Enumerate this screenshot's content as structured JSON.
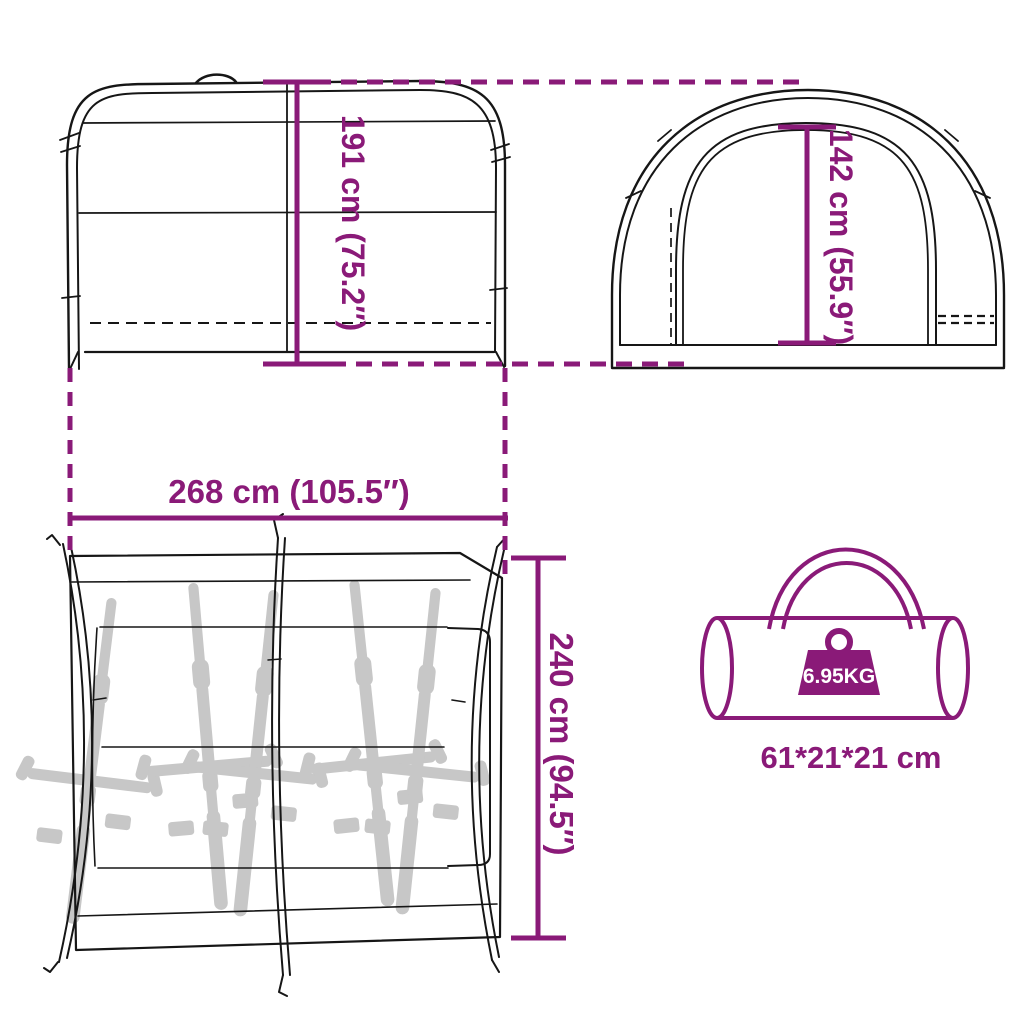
{
  "colors": {
    "accent": "#8A1A78",
    "line": "#161616",
    "bike_silhouette": "#c7c7c7",
    "background": "#ffffff",
    "weight_text": "#ffffff"
  },
  "diagram": {
    "side_view": {
      "height_label": "191 cm (75.2″)"
    },
    "front_view": {
      "door_height_label": "142 cm (55.9″)"
    },
    "floor_plan": {
      "width_label": "268 cm (105.5″)",
      "depth_label": "240 cm (94.5″)",
      "bike_count": 5
    },
    "carry_bag": {
      "weight_label": "6.95KG",
      "size_label": "61*21*21 cm"
    }
  },
  "icons": {
    "weight_icon": "filled trapezoid weight with ring handle",
    "carry_bag_icon": "duffel cylinder outline with double handle",
    "bike_icon": "bicycle top-view gray silhouette"
  }
}
